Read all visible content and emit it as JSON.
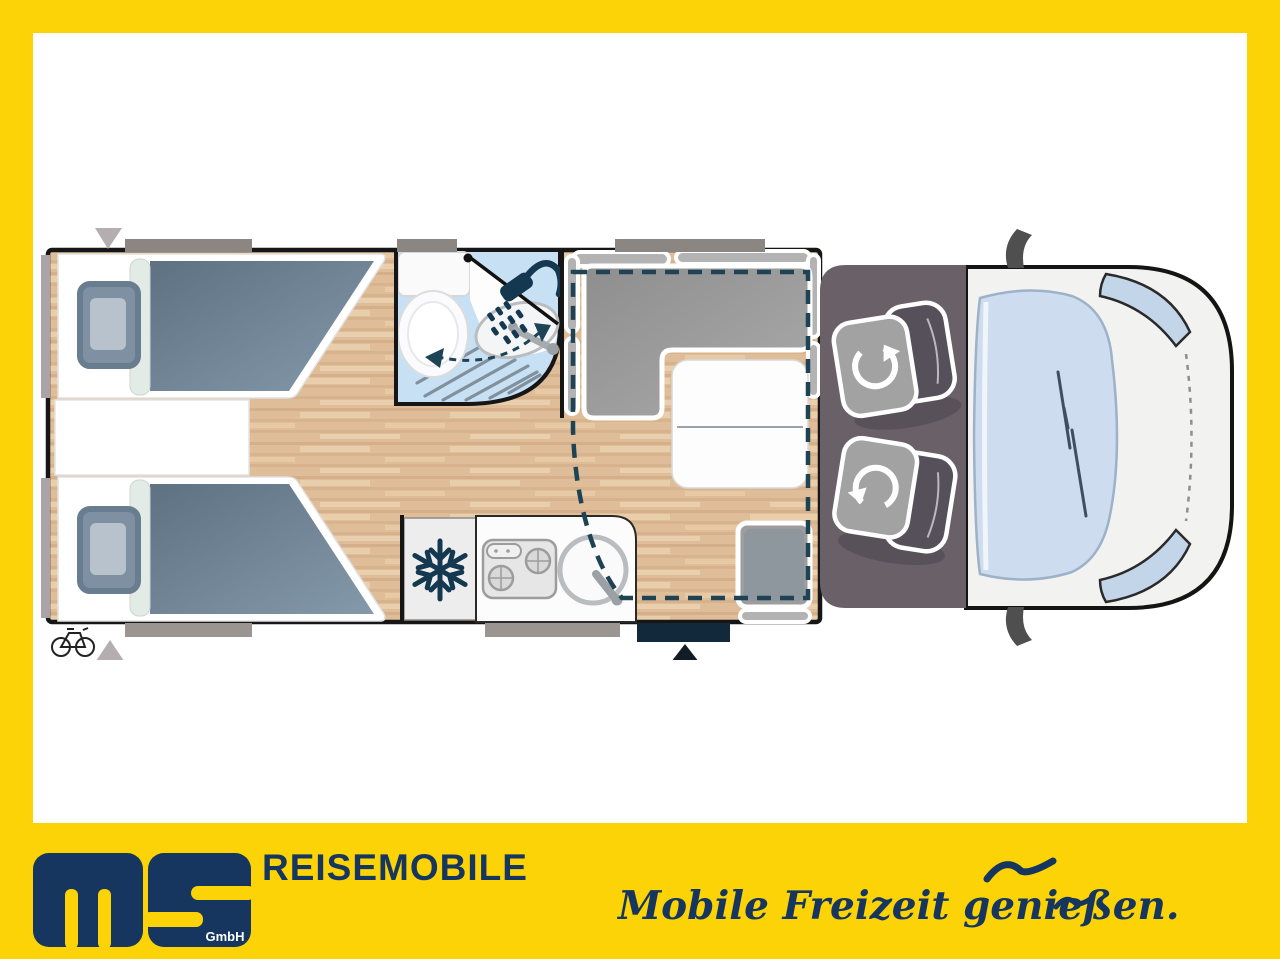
{
  "brand": {
    "logo_text": "ms",
    "logo_suffix": "GmbH",
    "wordmark": "REISEMOBILE",
    "slogan": "Mobile Freizeit genießen."
  },
  "colors": {
    "frame_yellow": "#FBD307",
    "brand_navy": "#17365F",
    "plan_dash_navy": "#1D4355",
    "floor_wood": "#DFBD99",
    "bed_slate": "#6D8191",
    "bath_blue": "#C8E0F4",
    "cab_gray": "#6A6067",
    "vehicle_body_white": "#F2F3F1",
    "windshield_blue": "#CDDCEE"
  },
  "floorplan": {
    "icons": [
      "snowflake-icon",
      "shower-icon",
      "toilet-icon",
      "washbasin-icon",
      "stove-icon",
      "kitchen-sink-icon",
      "swivel-arrow-icon",
      "entry-arrow-icon",
      "bike-rack-icon",
      "window-marker",
      "seagull-icon"
    ],
    "features": {
      "rear_beds": "twin-single-beds",
      "bathroom": "shower-toilet-washbasin",
      "kitchen": "fridge-stove-sink",
      "dinette": "l-bench-table-side-seat-dropdown-bed",
      "cab": "two-swivel-seats",
      "entry": "door-rear-right"
    }
  }
}
